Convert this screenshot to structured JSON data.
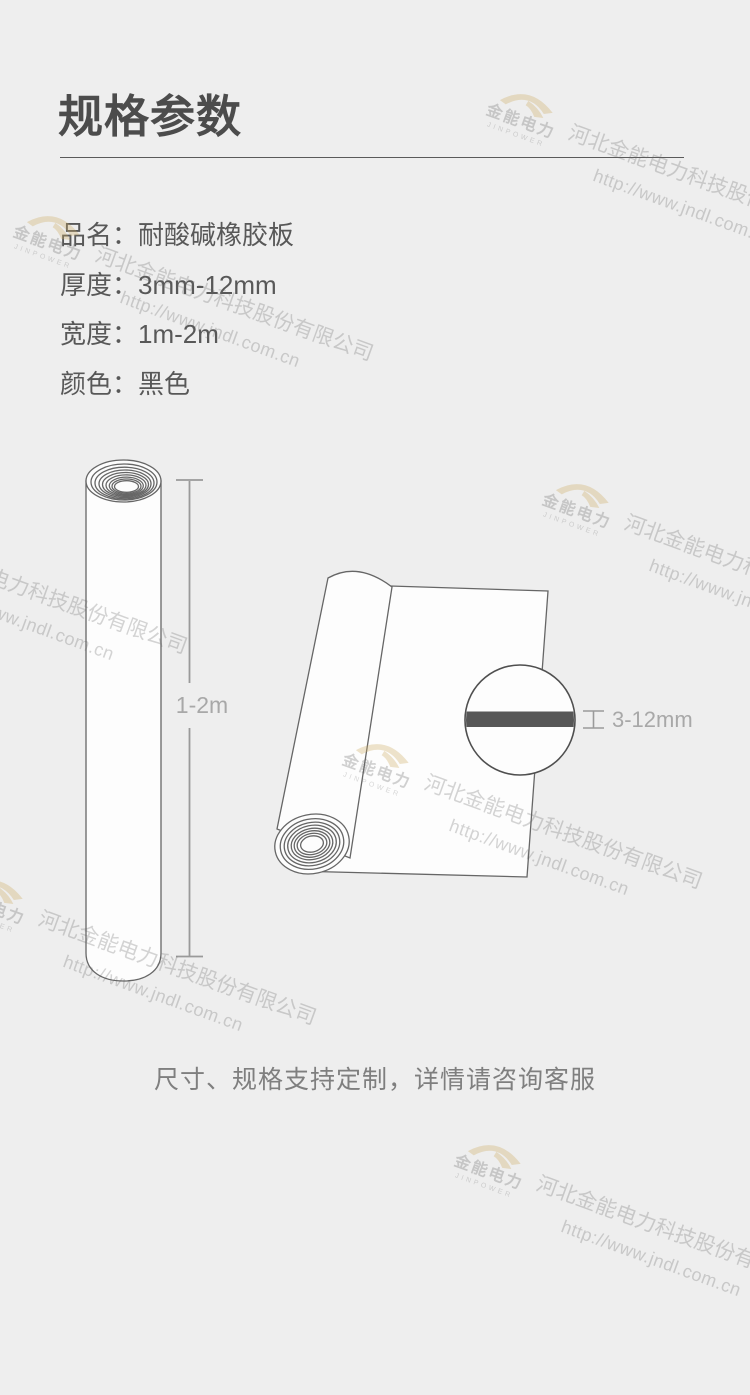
{
  "header": {
    "title": "规格参数"
  },
  "specs": [
    {
      "label": "品名：",
      "value": "耐酸碱橡胶板"
    },
    {
      "label": "厚度：",
      "value": "3mm-12mm"
    },
    {
      "label": "宽度：",
      "value": "1m-2m"
    },
    {
      "label": "颜色：",
      "value": "黑色"
    }
  ],
  "diagrams": {
    "length_label": "1-2m",
    "thickness_label": "3-12mm"
  },
  "footer": {
    "note": "尺寸、规格支持定制，详情请咨询客服"
  },
  "watermark": {
    "company": "河北金能电力科技股份有限公司",
    "url": "http://www.jndl.com.cn",
    "logo_name": "金能电力",
    "logo_sub": "JINPOWER"
  },
  "colors": {
    "background": "#eeeeee",
    "title_text": "#4c4c4c",
    "body_text": "#585858",
    "footer_text": "#7f7f7f",
    "dimension_text": "#a8a8a8",
    "illustration_outline": "#666666",
    "thickness_bar": "#575757",
    "watermark_text": "#cfcfcf",
    "logo_accent": "#e8d9ad"
  }
}
